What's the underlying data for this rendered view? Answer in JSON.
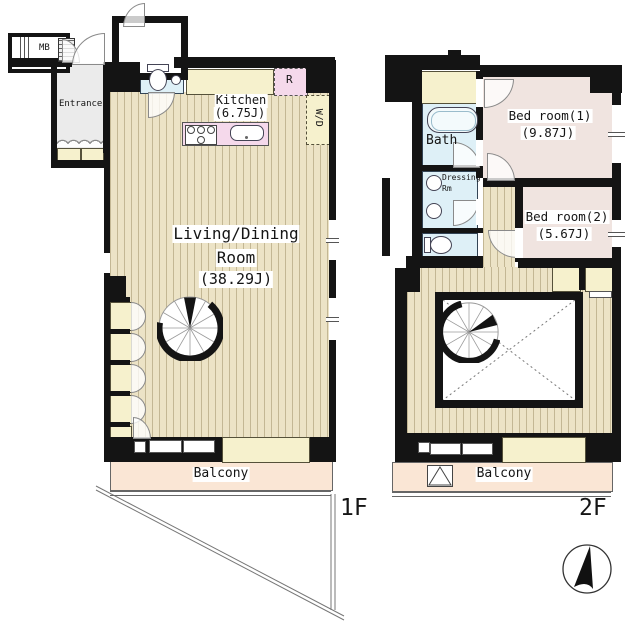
{
  "title": "Maisonette floor plan 1F/2F",
  "floor1": {
    "floor_label": "1F",
    "mb": "MB",
    "entrance": "Entrance",
    "kitchen_name": "Kitchen",
    "kitchen_area": "(6.75J)",
    "refrigerator": "R",
    "washer_dryer": "W/D",
    "living_name_1": "Living/Dining",
    "living_name_2": "Room",
    "living_area": "(38.29J)",
    "balcony": "Balcony"
  },
  "floor2": {
    "floor_label": "2F",
    "bath": "Bath",
    "dressing_1": "Dressing",
    "dressing_2": "Rm",
    "bedroom1_name": "Bed room(1)",
    "bedroom1_area": "(9.87J)",
    "bedroom2_name": "Bed room(2)",
    "bedroom2_area": "(5.67J)",
    "balcony": "Balcony"
  },
  "icons": {
    "compass": "north-arrow",
    "stairs_1f": "spiral-staircase",
    "stairs_2f": "spiral-staircase",
    "toilet_1f": "toilet",
    "toilet_2f": "toilet",
    "bathtub": "bathtub",
    "stove": "stove-burners",
    "sink": "kitchen-sink",
    "hatch": "balcony-escape-hatch",
    "void_mark": "open-void-cross"
  },
  "colors": {
    "wall": "#141414",
    "wood_floor": "#ece3c6",
    "wood_stripe": "#c3b794",
    "closet_cream": "#f6f1cd",
    "bedroom_pink": "#f0e4e0",
    "kitchen_pink": "#f5d9eb",
    "wet_area_blue": "#def0f7",
    "entrance_gray": "#ebebeb",
    "balcony_peach": "#fae6d5"
  }
}
